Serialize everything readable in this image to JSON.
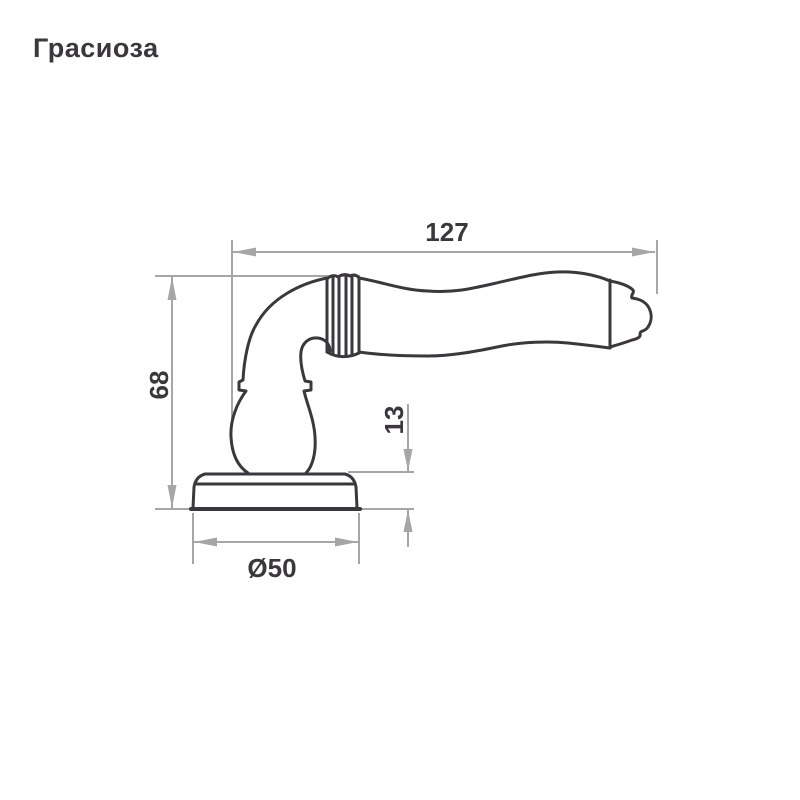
{
  "title": "Грасиоза",
  "drawing": {
    "subject": "door-lever-handle-side-view",
    "dimensions": {
      "length": {
        "value": "127"
      },
      "height": {
        "value": "68"
      },
      "rosette_height": {
        "value": "13"
      },
      "rosette_diameter": {
        "value": "Ø50"
      }
    }
  },
  "colors": {
    "background": "#ffffff",
    "outline": "#3a383c",
    "dimension_lines": "#a6a6a6",
    "text": "#3a383c"
  }
}
